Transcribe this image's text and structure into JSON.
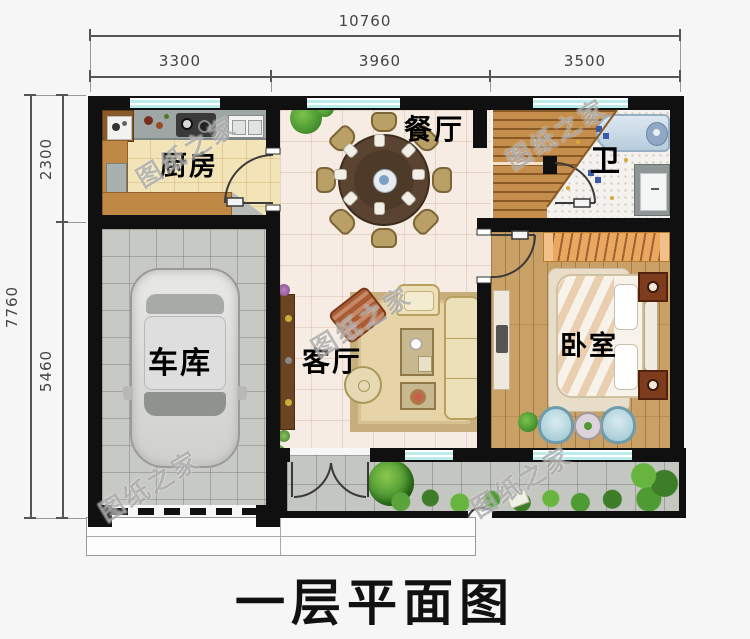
{
  "title": "一层平面图",
  "watermark": "图纸之家",
  "dimensions": {
    "top": {
      "total": "10760",
      "segments": [
        "3300",
        "3960",
        "3500"
      ]
    },
    "left": {
      "total": "7760",
      "segments": [
        "2300",
        "5460"
      ]
    }
  },
  "rooms": {
    "kitchen": {
      "label": "厨房"
    },
    "dining": {
      "label": "餐厅"
    },
    "bathroom": {
      "label": "卫"
    },
    "garage": {
      "label": "车库"
    },
    "living": {
      "label": "客厅"
    },
    "bedroom": {
      "label": "卧室"
    }
  },
  "colors": {
    "wall": "#101010",
    "window_glass": "#b9ecea",
    "floor_wood": "#c9a066",
    "accent_green": "#4e9a33",
    "title_text": "#111111",
    "dimension_text": "#444444"
  }
}
